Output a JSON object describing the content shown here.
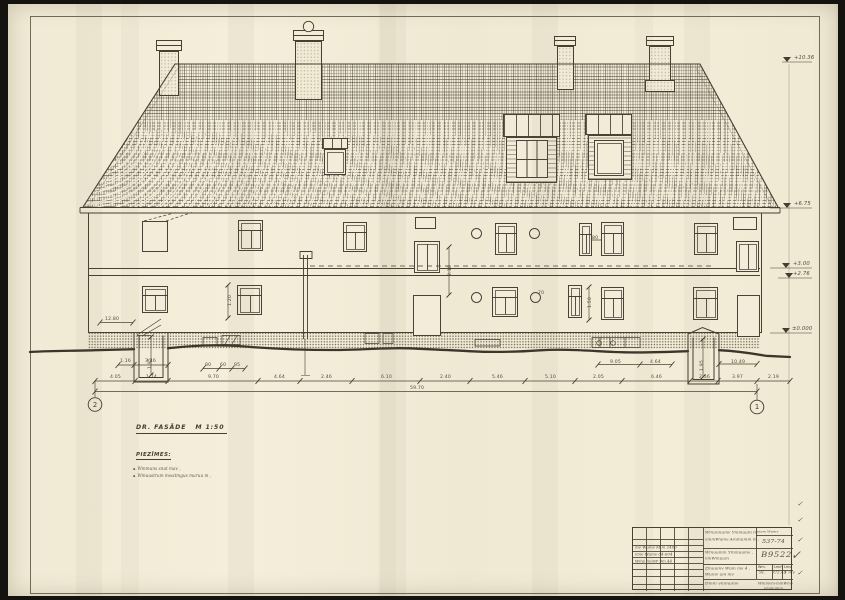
{
  "title": {
    "name": "DR. FASĀDE",
    "scale": "M 1:50"
  },
  "notes": {
    "heading": "PIEZĪMES:",
    "items": [
      "Wmmuns  snut  mav ,",
      "Wmuustrum  mwstmgus  muruu  m ,"
    ]
  },
  "axes": {
    "left": "2",
    "right": "1"
  },
  "title_block": {
    "code_label": "mam Wumv",
    "code": "537-74",
    "org1": "Wmunnumv  Ymmuum  m.",
    "org2": "vmmWumv  Ammumm  m ,",
    "proj1": "Wmuumm  Ymmuumv ,",
    "proj2": "vmWmuum",
    "number": "B9522",
    "obj1": "Zmuumv  Wum  mv  4 ,",
    "obj2": "Wumv   um  mv",
    "col1_h": "Wm.",
    "col2_h": "Lmm",
    "col3_h": "Lmv",
    "col1_v": "9c.",
    "col2_v": "U2.49",
    "col3_v": "1 mv",
    "sheet_name": "Dmm   vmmumv",
    "firm1": "Wmmvm-mmWmv",
    "firm2": "vmmumm",
    "rev1": "mv Wumv M m 2400",
    "rev2": "vmv Wumv 04-604",
    "rev3": "Wmv mmW 9m 44"
  },
  "labels": [
    {
      "x": 110,
      "y": 374.5,
      "t": "4.05"
    },
    {
      "x": 146,
      "y": 374.5,
      "t": "1.74"
    },
    {
      "x": 208,
      "y": 374.5,
      "t": "9.70"
    },
    {
      "x": 274,
      "y": 374.5,
      "t": "4.64"
    },
    {
      "x": 321,
      "y": 374.5,
      "t": "2.46"
    },
    {
      "x": 381,
      "y": 374.5,
      "t": "6.10"
    },
    {
      "x": 440,
      "y": 374.5,
      "t": "2.40"
    },
    {
      "x": 492,
      "y": 374.5,
      "t": "5.46"
    },
    {
      "x": 545,
      "y": 374.5,
      "t": "5.10"
    },
    {
      "x": 593,
      "y": 374.5,
      "t": "2.05"
    },
    {
      "x": 651,
      "y": 374.5,
      "t": "6.46"
    },
    {
      "x": 699,
      "y": 374.5,
      "t": "2.56"
    },
    {
      "x": 732,
      "y": 374.5,
      "t": "3.97"
    },
    {
      "x": 768,
      "y": 374.5,
      "t": "2.19"
    },
    {
      "x": 410,
      "y": 385.5,
      "t": "59.70"
    },
    {
      "x": 120,
      "y": 358.5,
      "t": "1.16"
    },
    {
      "x": 145,
      "y": 358.5,
      "t": "3.46"
    },
    {
      "x": 205,
      "y": 362.5,
      "t": "80"
    },
    {
      "x": 220,
      "y": 362.5,
      "t": "60"
    },
    {
      "x": 234,
      "y": 362.5,
      "t": "95"
    },
    {
      "x": 610,
      "y": 359.5,
      "t": "9.05"
    },
    {
      "x": 650,
      "y": 359.5,
      "t": "4.64"
    },
    {
      "x": 731,
      "y": 359.5,
      "t": "10.49"
    },
    {
      "x": 228,
      "y": 306,
      "t": "1.20",
      "r": -90
    },
    {
      "x": 448,
      "y": 276,
      "t": "2.10",
      "r": -90
    },
    {
      "x": 588,
      "y": 308,
      "t": "1.50",
      "r": -90
    },
    {
      "x": 148,
      "y": 369,
      "t": "1.95",
      "r": -90
    },
    {
      "x": 700,
      "y": 371,
      "t": "1.95",
      "r": -90
    },
    {
      "x": 592,
      "y": 235.5,
      "t": "80"
    },
    {
      "x": 538,
      "y": 290.5,
      "t": "70"
    },
    {
      "x": 105,
      "y": 316.5,
      "t": "12.80"
    },
    {
      "x": 794,
      "y": 54.5,
      "t": "+10.36",
      "cls": "lvl"
    },
    {
      "x": 794,
      "y": 200.5,
      "t": "+6.75",
      "cls": "lvl"
    },
    {
      "x": 793,
      "y": 260.5,
      "t": "+3.00",
      "cls": "lvl"
    },
    {
      "x": 793,
      "y": 270.5,
      "t": "+2.76",
      "cls": "lvl"
    },
    {
      "x": 792,
      "y": 325.5,
      "t": "±0.000",
      "cls": "lvl"
    },
    {
      "x": 797,
      "y": 500,
      "t": "✓",
      "cls": "chk"
    },
    {
      "x": 797,
      "y": 516,
      "t": "✓",
      "cls": "chk"
    },
    {
      "x": 797,
      "y": 536,
      "t": "✓",
      "cls": "chk"
    },
    {
      "x": 791,
      "y": 548,
      "t": "✓",
      "cls": "chk",
      "fs": 12
    },
    {
      "x": 797,
      "y": 569,
      "t": "✓",
      "cls": "chk"
    }
  ]
}
